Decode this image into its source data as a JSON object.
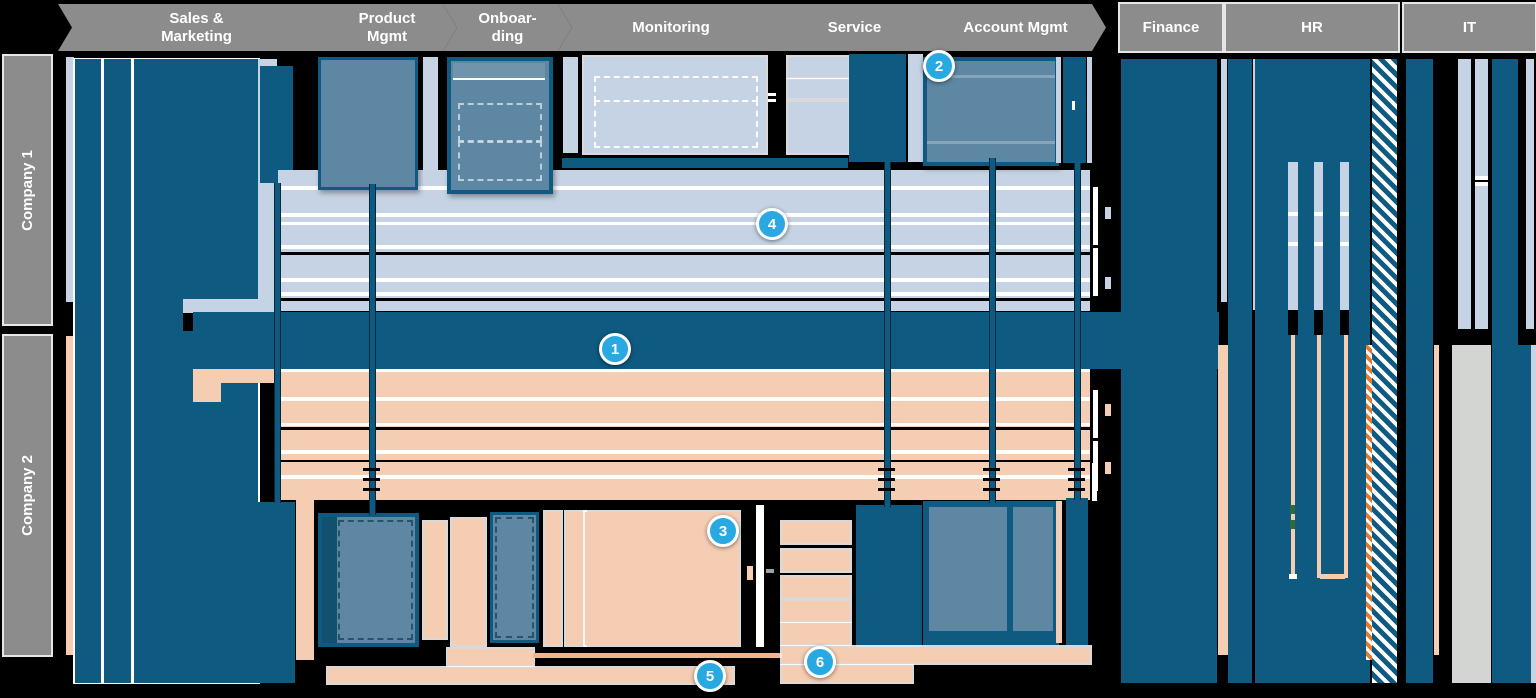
{
  "header": {
    "process_steps": [
      {
        "label": "Sales &\nMarketing"
      },
      {
        "label": "Product\nMgmt"
      },
      {
        "label": "Onboar-\nding"
      },
      {
        "label": "Monitoring"
      },
      {
        "label": "Service"
      },
      {
        "label": "Account Mgmt"
      }
    ],
    "departments": [
      {
        "label": "Finance"
      },
      {
        "label": "HR"
      },
      {
        "label": "IT"
      }
    ]
  },
  "rows": [
    {
      "label": "Company 1"
    },
    {
      "label": "Company 2"
    }
  ],
  "badges": [
    "1",
    "2",
    "3",
    "4",
    "5",
    "6"
  ],
  "colors": {
    "dark_blue": "#0e5a80",
    "steel_blue": "#5d87a3",
    "light_blue_company1": "#c6d3e4",
    "peach_company2": "#f5cdb3",
    "header_gray": "#8c8c8c",
    "badge_cyan": "#29a9e1",
    "hatch_orange": "#e8782a",
    "it_gray_column": "#d2d5d1"
  }
}
